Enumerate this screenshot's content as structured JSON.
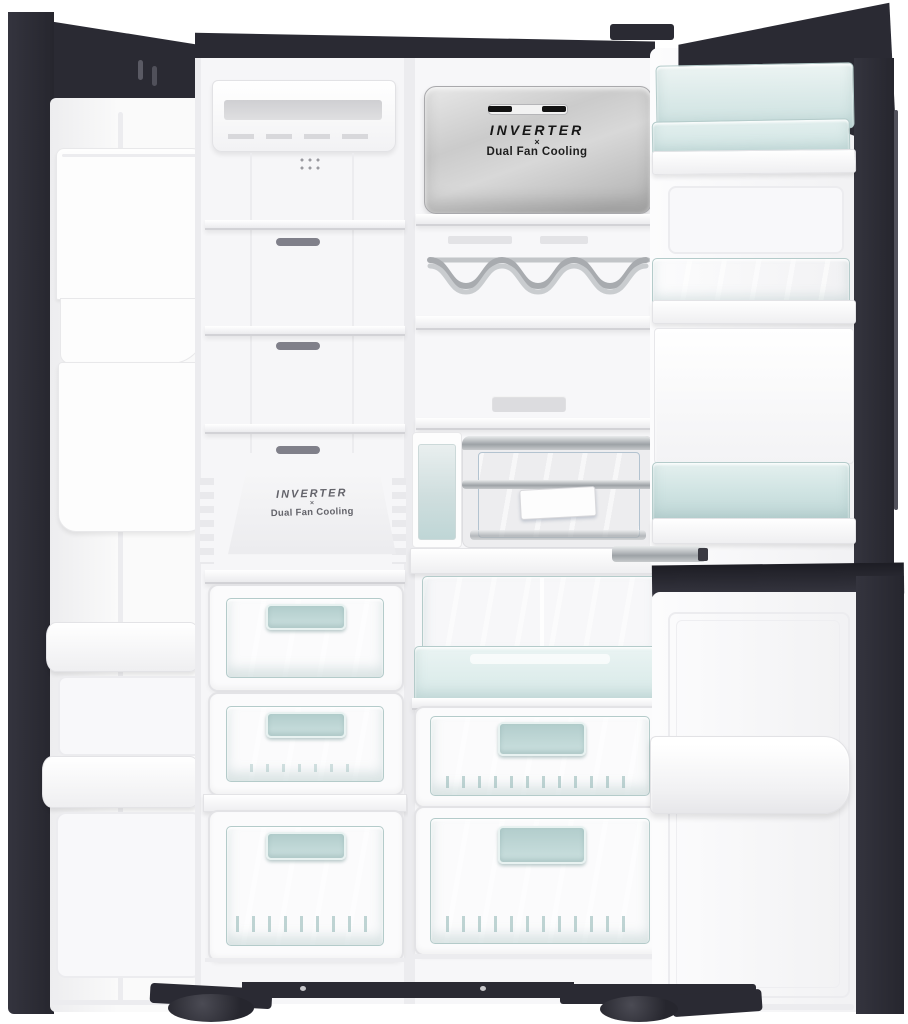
{
  "window": {
    "width": 908,
    "height": 1024
  },
  "product": {
    "description": "side-by-side refrigerator with all doors open, empty interior",
    "fridge_badge": {
      "brand_line": "INVERTER",
      "multiply": "×",
      "feature_line": "Dual Fan Cooling"
    },
    "freezer_badge": {
      "brand_line": "INVERTER",
      "multiply": "×",
      "feature_line": "Dual Fan Cooling"
    }
  },
  "colors": {
    "door_dark": "#2b2b34",
    "cabinet_white": "#fafafa",
    "interior_shadow": "#e7e7ea",
    "glass_tint": "#d5e7e6",
    "glass_tint_deep": "#bcd4d4",
    "vacuum_case_tint": "#c2d2de",
    "metallic_silver": "#c6c6c6",
    "chrome": "#9da2a6",
    "badge_text_dark": "#161616",
    "badge_text_gray": "#63636a",
    "background": "#ffffff"
  }
}
